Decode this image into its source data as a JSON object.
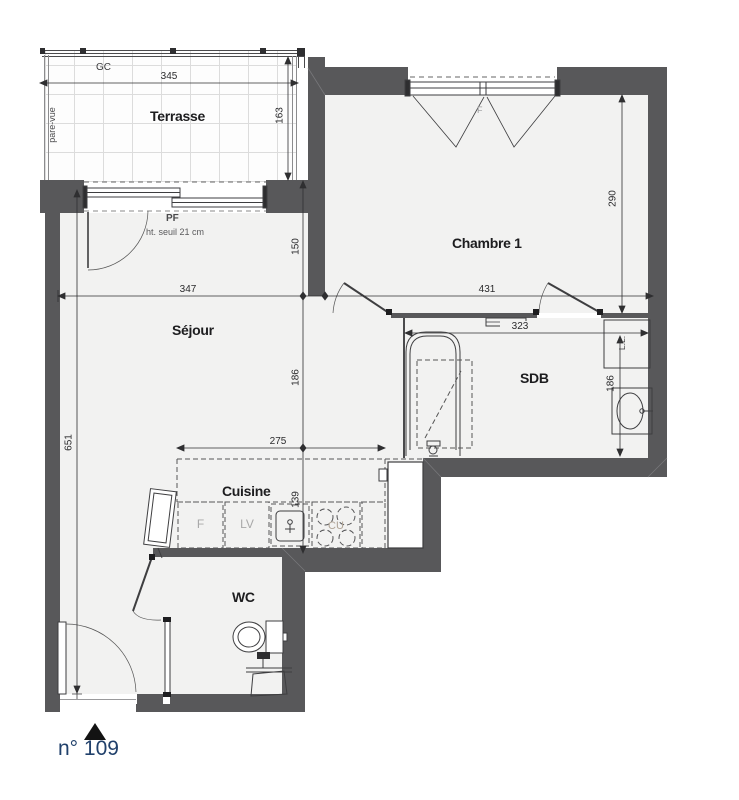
{
  "unit": {
    "number": "n° 109"
  },
  "rooms": {
    "terrace": "Terrasse",
    "bedroom": "Chambre 1",
    "living": "Séjour",
    "bathroom": "SDB",
    "kitchen": "Cuisine",
    "wc": "WC"
  },
  "annotations": {
    "gc": "GC",
    "pare_vue": "pare-vue",
    "pf": "PF",
    "pf_note": "ht. seuil 21 cm",
    "window_f": "F",
    "washing_machine": "L.L.",
    "fridge": "F",
    "dishwasher": "LV",
    "hob": "CU"
  },
  "dimensions": {
    "terrace_width": "345",
    "terrace_depth": "163",
    "living_top": "150",
    "living_width": "347",
    "bedroom_width": "431",
    "bedroom_depth": "290",
    "bathroom_width": "323",
    "bathroom_depth": "186",
    "living_height": "186",
    "kitchen_width": "275",
    "kitchen_depth": "139",
    "left_height": "651"
  },
  "colors": {
    "wall": "#58585a",
    "line": "#3e3e40",
    "floor": "#f2f2f1",
    "unit_label": "#20406b",
    "muted_label": "#a8a8a8"
  }
}
